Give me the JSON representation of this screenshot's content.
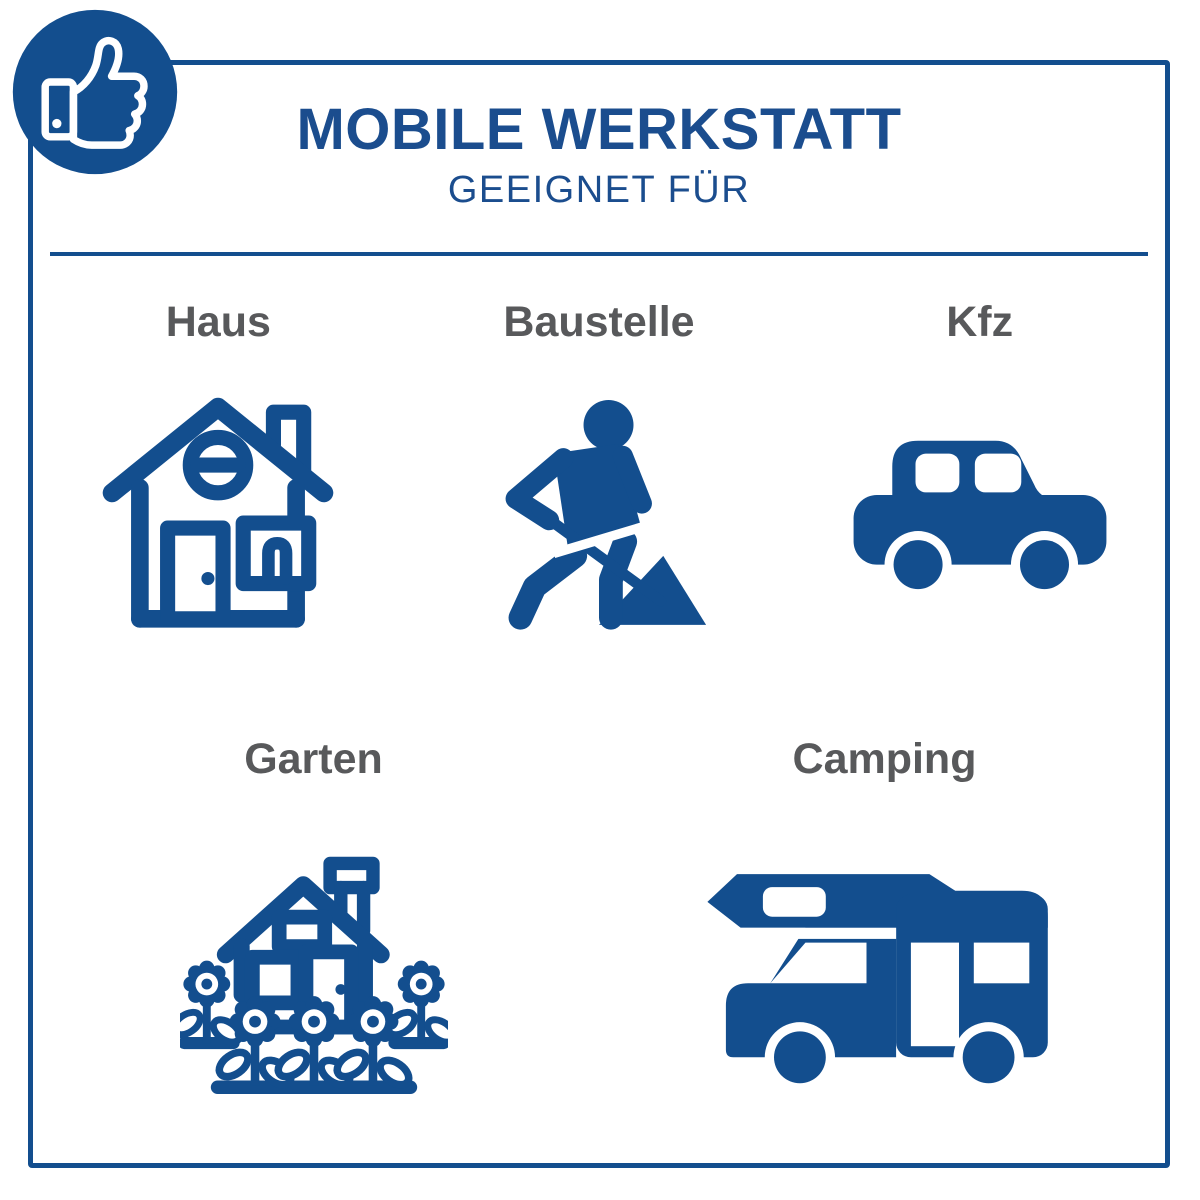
{
  "badge": {
    "icon": "thumbs-up-icon"
  },
  "header": {
    "title": "MOBILE WERKSTATT",
    "subtitle": "GEEIGNET FÜR"
  },
  "items": [
    {
      "label": "Haus",
      "icon": "house-icon"
    },
    {
      "label": "Baustelle",
      "icon": "construction-worker-icon"
    },
    {
      "label": "Kfz",
      "icon": "car-icon"
    },
    {
      "label": "Garten",
      "icon": "garden-house-flowers-icon"
    },
    {
      "label": "Camping",
      "icon": "camper-van-icon"
    }
  ],
  "colors": {
    "primary_blue": "#134e8e",
    "label_gray": "#58595b",
    "background": "#ffffff"
  }
}
